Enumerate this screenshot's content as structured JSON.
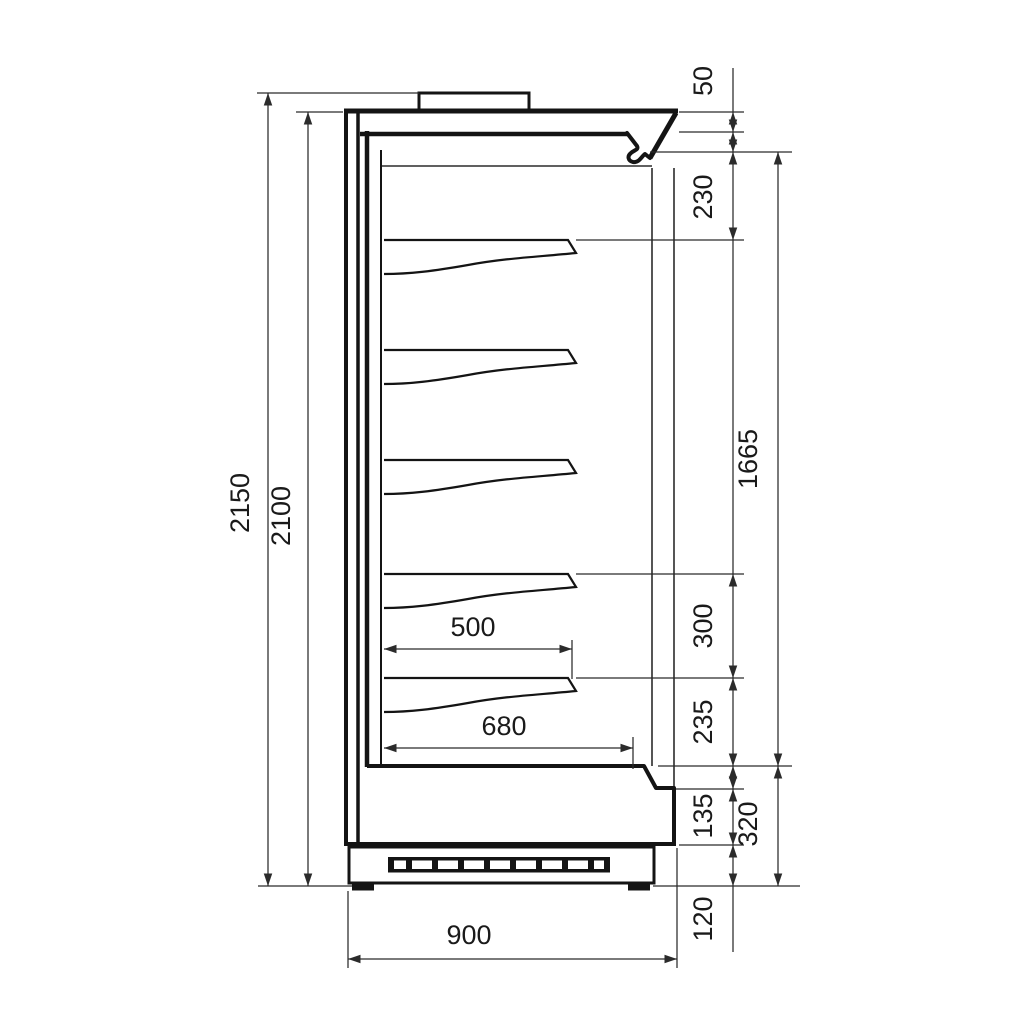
{
  "diagram": {
    "kind": "technical-dimension-drawing",
    "subject": "refrigerated multideck cabinet, side section view",
    "units": "mm",
    "background": "#ffffff",
    "line_color": "#141414",
    "shelf_count": 5,
    "grille_slot_count": 10,
    "labels": {
      "overall_height": "2150",
      "height_without_top": "2100",
      "top_edge": "50",
      "first_shelf_gap": "230",
      "inner_height": "1665",
      "shelf_spacing": "300",
      "bottom_shelf_to_deck": "235",
      "front_panel": "135",
      "deck_to_floor": "320",
      "plinth_height": "120",
      "shelf_depth": "500",
      "deck_depth": "680",
      "overall_depth": "900"
    }
  }
}
